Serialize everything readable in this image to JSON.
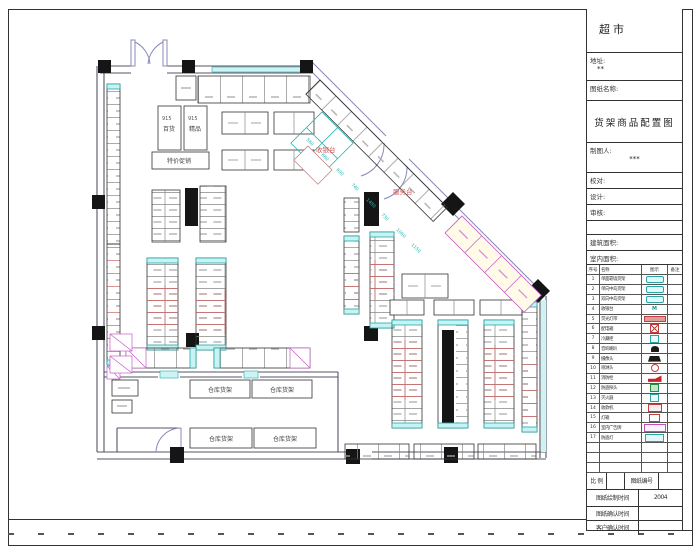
{
  "sheet": {
    "project_title": "超市",
    "address_label": "地址:",
    "address_value": "**",
    "drawing_name_label": "图纸名称:",
    "drawing_title": "货架商品配置图",
    "drafter_label": "制图人:",
    "drafter_value": "***",
    "check_label": "校对:",
    "design_label": "设计:",
    "review_label": "审核:",
    "building_area_label": "建筑面积:",
    "indoor_area_label": "室内面积:",
    "scale_label": "比 例",
    "drawing_no_label": "图纸编号",
    "draw_time_label": "图纸绘制时间",
    "draw_time_value": "2004",
    "drawing_confirm_label": "图纸确认时间",
    "customer_confirm_label": "客户确认时间"
  },
  "legend": {
    "headers": [
      "序号",
      "名称",
      "图示",
      "备注"
    ],
    "rows": [
      {
        "no": "1",
        "name": "单面靠墙货架",
        "icon": "rect-cyan"
      },
      {
        "no": "2",
        "name": "单向中岛货架",
        "icon": "rect-cyan"
      },
      {
        "no": "3",
        "name": "双向中岛货架",
        "icon": "rect-cyan"
      },
      {
        "no": "4",
        "name": "收银台",
        "icon": "m-text",
        "icon_text": "M"
      },
      {
        "no": "5",
        "name": "荧光灯带",
        "icon": "bar-red"
      },
      {
        "no": "6",
        "name": "配电箱",
        "icon": "box-red-x"
      },
      {
        "no": "7",
        "name": "冷藏柜",
        "icon": "small-cyan"
      },
      {
        "no": "8",
        "name": "音响喇叭",
        "icon": "speaker"
      },
      {
        "no": "9",
        "name": "摄像头",
        "icon": "dome"
      },
      {
        "no": "10",
        "name": "喷淋头",
        "icon": "circle-red"
      },
      {
        "no": "11",
        "name": "消防栓",
        "icon": "flag-red"
      },
      {
        "no": "12",
        "name": "防盗探头",
        "icon": "box-green"
      },
      {
        "no": "13",
        "name": "灭火器",
        "icon": "small-cyan"
      },
      {
        "no": "14",
        "name": "收款机",
        "icon": "box-red-text"
      },
      {
        "no": "15",
        "name": "灯箱",
        "icon": "box-red-sm"
      },
      {
        "no": "16",
        "name": "室内广告牌",
        "icon": "box-magenta"
      },
      {
        "no": "17",
        "name": "防盗灯",
        "icon": "box-cyan"
      },
      {
        "no": "",
        "name": "",
        "icon": ""
      },
      {
        "no": "",
        "name": "",
        "icon": ""
      },
      {
        "no": "",
        "name": "",
        "icon": ""
      }
    ]
  },
  "plan": {
    "labels": {
      "cashier": "收银台",
      "service": "服务台",
      "storage": "仓库货架",
      "dept1": "百货",
      "dept2": "精品",
      "promo": "特价促销",
      "model": "915"
    },
    "dims": [
      "560",
      "660",
      "690",
      "740",
      "1480",
      "730",
      "1060",
      "1150"
    ]
  },
  "colors": {
    "cyan": "#2ab5b5",
    "red": "#cc4444",
    "magenta": "#cc55cc",
    "wall": "#555566",
    "column": "#151515"
  }
}
